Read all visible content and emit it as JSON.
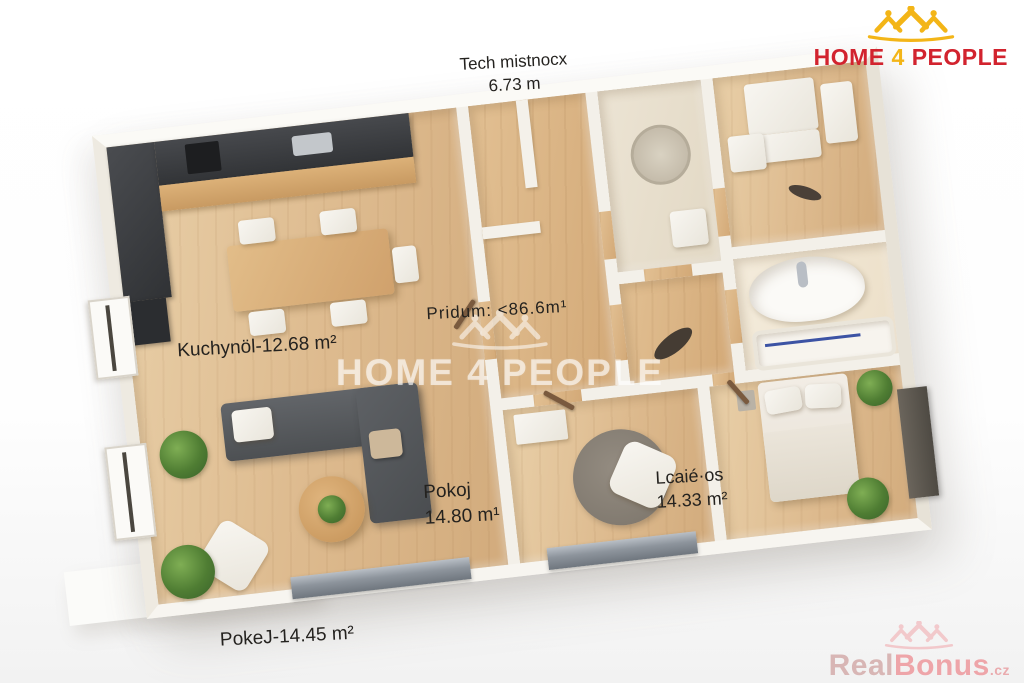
{
  "logo": {
    "home": "HOME",
    "four": "4",
    "people": "PEOPLE"
  },
  "center_watermark": {
    "text": "HOME 4 PEOPLE"
  },
  "footer_watermark": {
    "real": "Real",
    "bonus": "Bonus",
    "tld": ".cz"
  },
  "labels": {
    "tech_title": "Tech mistnocx",
    "tech_area": "6.73 m",
    "total_area": "Pridum:  <86.6m¹",
    "kitchen": "Kuchynöl-12.68 m²",
    "room_center_title": "Pokoj",
    "room_center_area": "14.80 m¹",
    "bedroom_title": "Lcaié·os",
    "bedroom_area": "14.33 m²",
    "room_bottom": "PokeJ-14.45 m²"
  },
  "colors": {
    "logo_red": "#d2232e",
    "logo_yellow": "#f3b517",
    "realbonus_pink": "#ee9297",
    "realbonus_gray": "#d2a8a6",
    "label_ink": "#24221f",
    "floor_wood": "#ddb88b",
    "wall_white": "#f2efe8",
    "kitchen_counter_dark": "#3f4144",
    "sofa_gray": "#55585c",
    "tub_line_blue": "#3c53a4"
  }
}
